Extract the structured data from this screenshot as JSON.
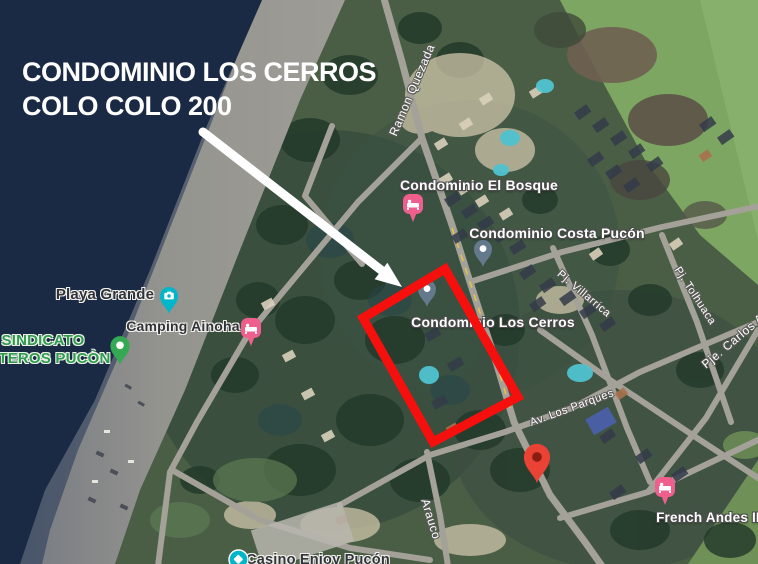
{
  "annotation": {
    "title": {
      "line1": "CONDOMINIO LOS CERROS",
      "line2": "COLO COLO 200"
    },
    "highlight_color": "#f5100e",
    "arrow_color": "#ffffff"
  },
  "map": {
    "places": {
      "el_bosque": "Condominio El Bosque",
      "costa_pucon": "Condominio Costa Pucón",
      "los_cerros": "Condominio Los Cerros",
      "playa_grande": "Playa Grande",
      "camping_ainoha": "Camping Ainoha",
      "sindicato_line1": "SINDICATO",
      "sindicato_line2": "BOTEROS PUCÒN",
      "french_andes": "French Andes II",
      "casino": "Casino Enjoy Pucón"
    },
    "streets": {
      "ramon_quezada": "Ramon Quezada",
      "villarrica": "Pj. Villarrica",
      "tolhuaca": "Pj. Tolhuaca",
      "carlos": "Pje. Carlos A",
      "los_parques": "Av. Los Parques",
      "arauco": "Arauco"
    },
    "pin_colors": {
      "lodging_pink": "#ee5f8d",
      "poi_teal": "#00b6c9",
      "poi_green": "#34a853",
      "poi_gray": "#64798c",
      "destination_red": "#ea4335",
      "destination_red_dot": "#8a1d12"
    },
    "terrain_colors": {
      "water": "#1a2944",
      "beach": "#94948f",
      "forest": "#2c4336",
      "field": "#7da662",
      "road": "#a3a198"
    }
  }
}
